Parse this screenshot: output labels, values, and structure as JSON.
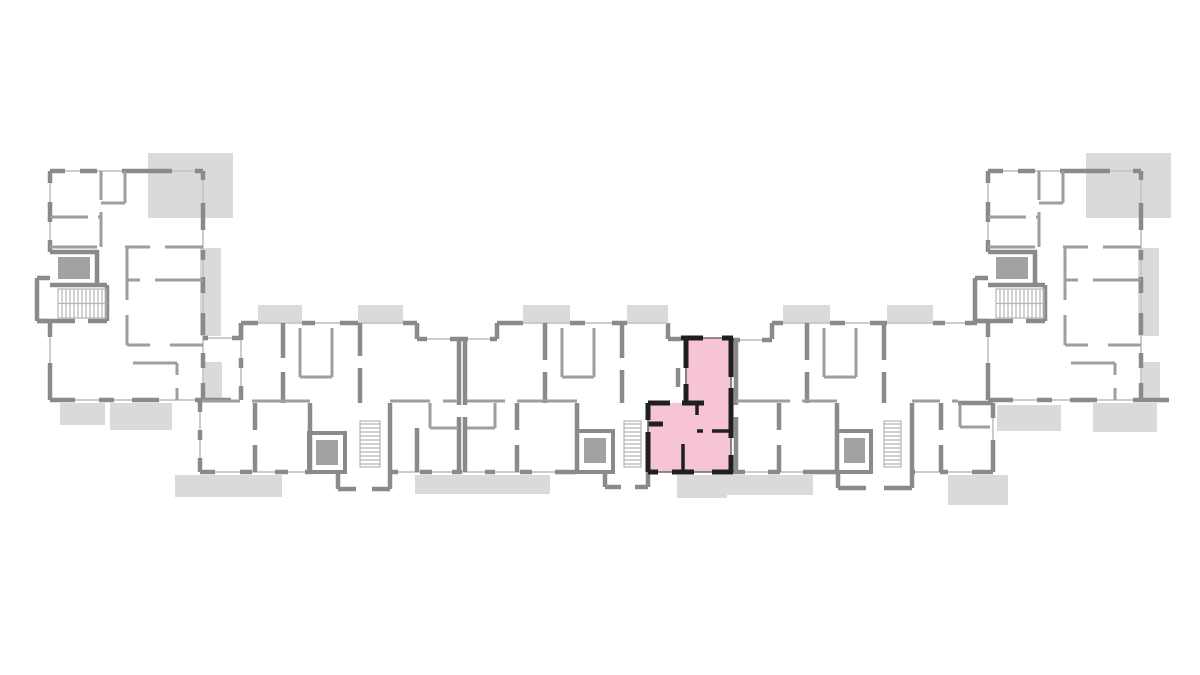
{
  "plan": {
    "type": "architectural-floor-plan",
    "title": "floor-plan-with-highlighted-apartment",
    "colors": {
      "background": "#ffffff",
      "wall": "#8a8a8a",
      "wall_light": "#9e9e9e",
      "window": "#c6c6c6",
      "balcony": "#dadada",
      "lift": "#a2a2a2",
      "unit_fill": "#f7c4d3",
      "unit_outline": "#1f1f1f"
    },
    "structure": {
      "wings": 2,
      "central_bar_stair_cores": 3,
      "wing_stair_cores": 2,
      "elevators_visible": 5,
      "stair_flights_visible": 5,
      "balconies_visible": 17
    }
  },
  "highlighted_unit": {
    "fill": "#f7c4d3",
    "outline": "#1f1f1f",
    "outline_points": "686,338 731,338 731,472 648,472 648,403 686,403",
    "location": "center-right of central bar, beside middle stair core",
    "rooms_visible": 4,
    "shape": "T-shaped"
  }
}
